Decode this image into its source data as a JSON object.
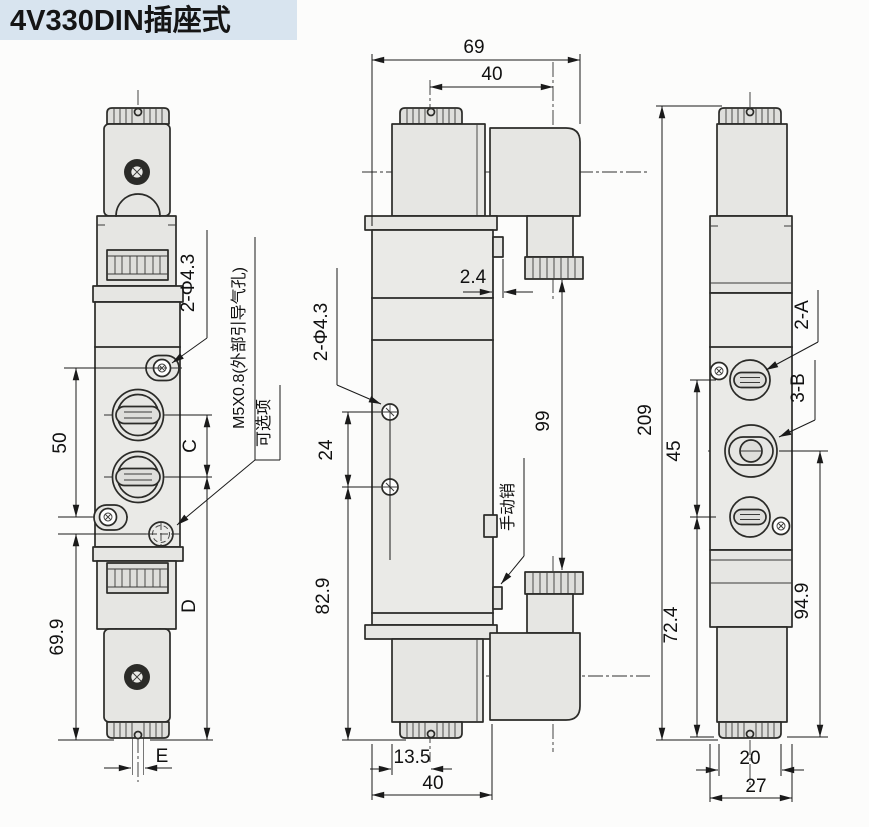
{
  "title": "4V330DIN插座式",
  "colors": {
    "title_bg": "#d8e4ef",
    "line": "#2b2b28",
    "fill_light": "#eaeae7",
    "fill_mid": "#e3e3e0",
    "dim_text": "#111111"
  },
  "front_view": {
    "dim_screw_span": "50",
    "dim_lower": "69.9",
    "dim_port_pitch": "C",
    "dim_port_to_base": "D",
    "dim_exhaust": "E",
    "label_mount_holes": "2-Φ4.3",
    "label_pilot_port": "M5X0.8(外部引导气孔)",
    "label_optional": "可选项"
  },
  "side_view": {
    "dim_width": "69",
    "dim_coil_to_plug": "40",
    "dim_tab": "2.4",
    "dim_plug_span": "99",
    "label_mount_holes": "2-Φ4.3",
    "dim_hole_pitch": "24",
    "dim_hole_to_base": "82.9",
    "label_manual_pin": "手动销",
    "dim_cap_offset": "13.5",
    "dim_body_width": "40"
  },
  "end_view": {
    "dim_height": "209",
    "dim_port_span": "45",
    "dim_lower": "72.4",
    "dim_upper_span": "94.9",
    "dim_cap_width": "20",
    "dim_body_width": "27",
    "label_port_a": "2-A",
    "label_port_b": "3-B"
  }
}
